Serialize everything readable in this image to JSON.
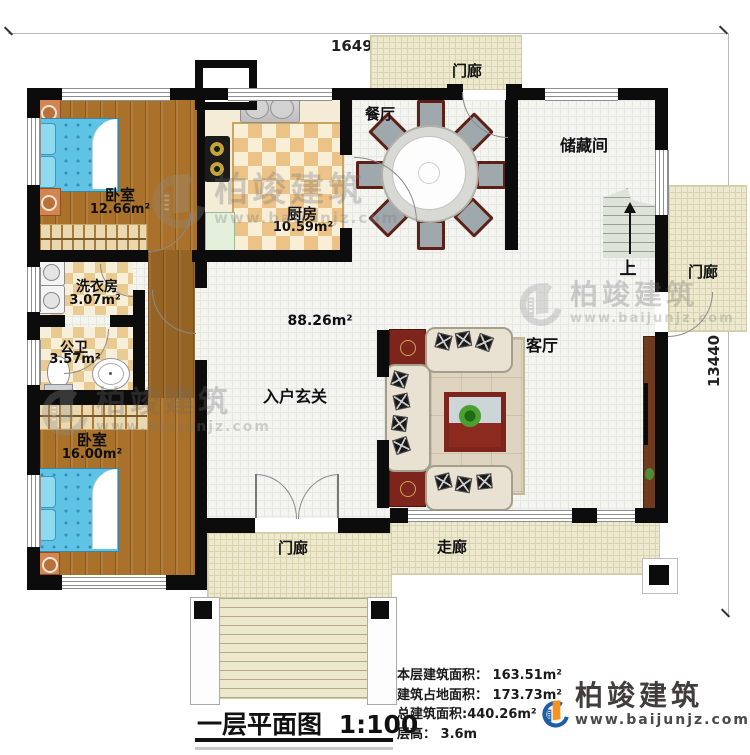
{
  "dimensions": {
    "top": "16490",
    "right": "13440"
  },
  "rooms": {
    "bedroom1": {
      "name": "卧室",
      "area": "12.66m²"
    },
    "kitchen": {
      "name": "厨房",
      "area": "10.59m²"
    },
    "dining": {
      "name": "餐厅"
    },
    "porch_top": {
      "name": "门廊"
    },
    "storage": {
      "name": "储藏间"
    },
    "stairs_up": {
      "name": "上"
    },
    "porch_right": {
      "name": "门廊"
    },
    "laundry": {
      "name": "洗衣房",
      "area": "3.07m²"
    },
    "bathroom": {
      "name": "公卫",
      "area": "3.57m²"
    },
    "bedroom2": {
      "name": "卧室",
      "area": "16.00m²"
    },
    "foyer": {
      "name": "入户玄关",
      "area": "88.26m²"
    },
    "living": {
      "name": "客厅"
    },
    "porch_bottom": {
      "name": "门廊"
    },
    "corridor": {
      "name": "走廊"
    }
  },
  "title": {
    "text": "一层平面图",
    "scale": "1:100"
  },
  "info": {
    "lines": [
      "本层建筑面积： 163.51m²",
      "建筑占地面积： 173.73m²",
      "总建筑面积:440.26m²",
      "层高： 3.6m"
    ]
  },
  "brand": {
    "name": "柏竣建筑",
    "url": "www.baijunjz.com"
  },
  "watermark": {
    "name": "柏竣建筑",
    "url": "www.baijunjz.com"
  },
  "colors": {
    "wall": "#0c0c0c",
    "wood": "#a97129",
    "checker": "#e9cb92",
    "porch": "#ede9cf",
    "bed_blue": "#5fc3e6",
    "brand_blue": "#1f5da8",
    "brand_orange": "#f6921e"
  }
}
